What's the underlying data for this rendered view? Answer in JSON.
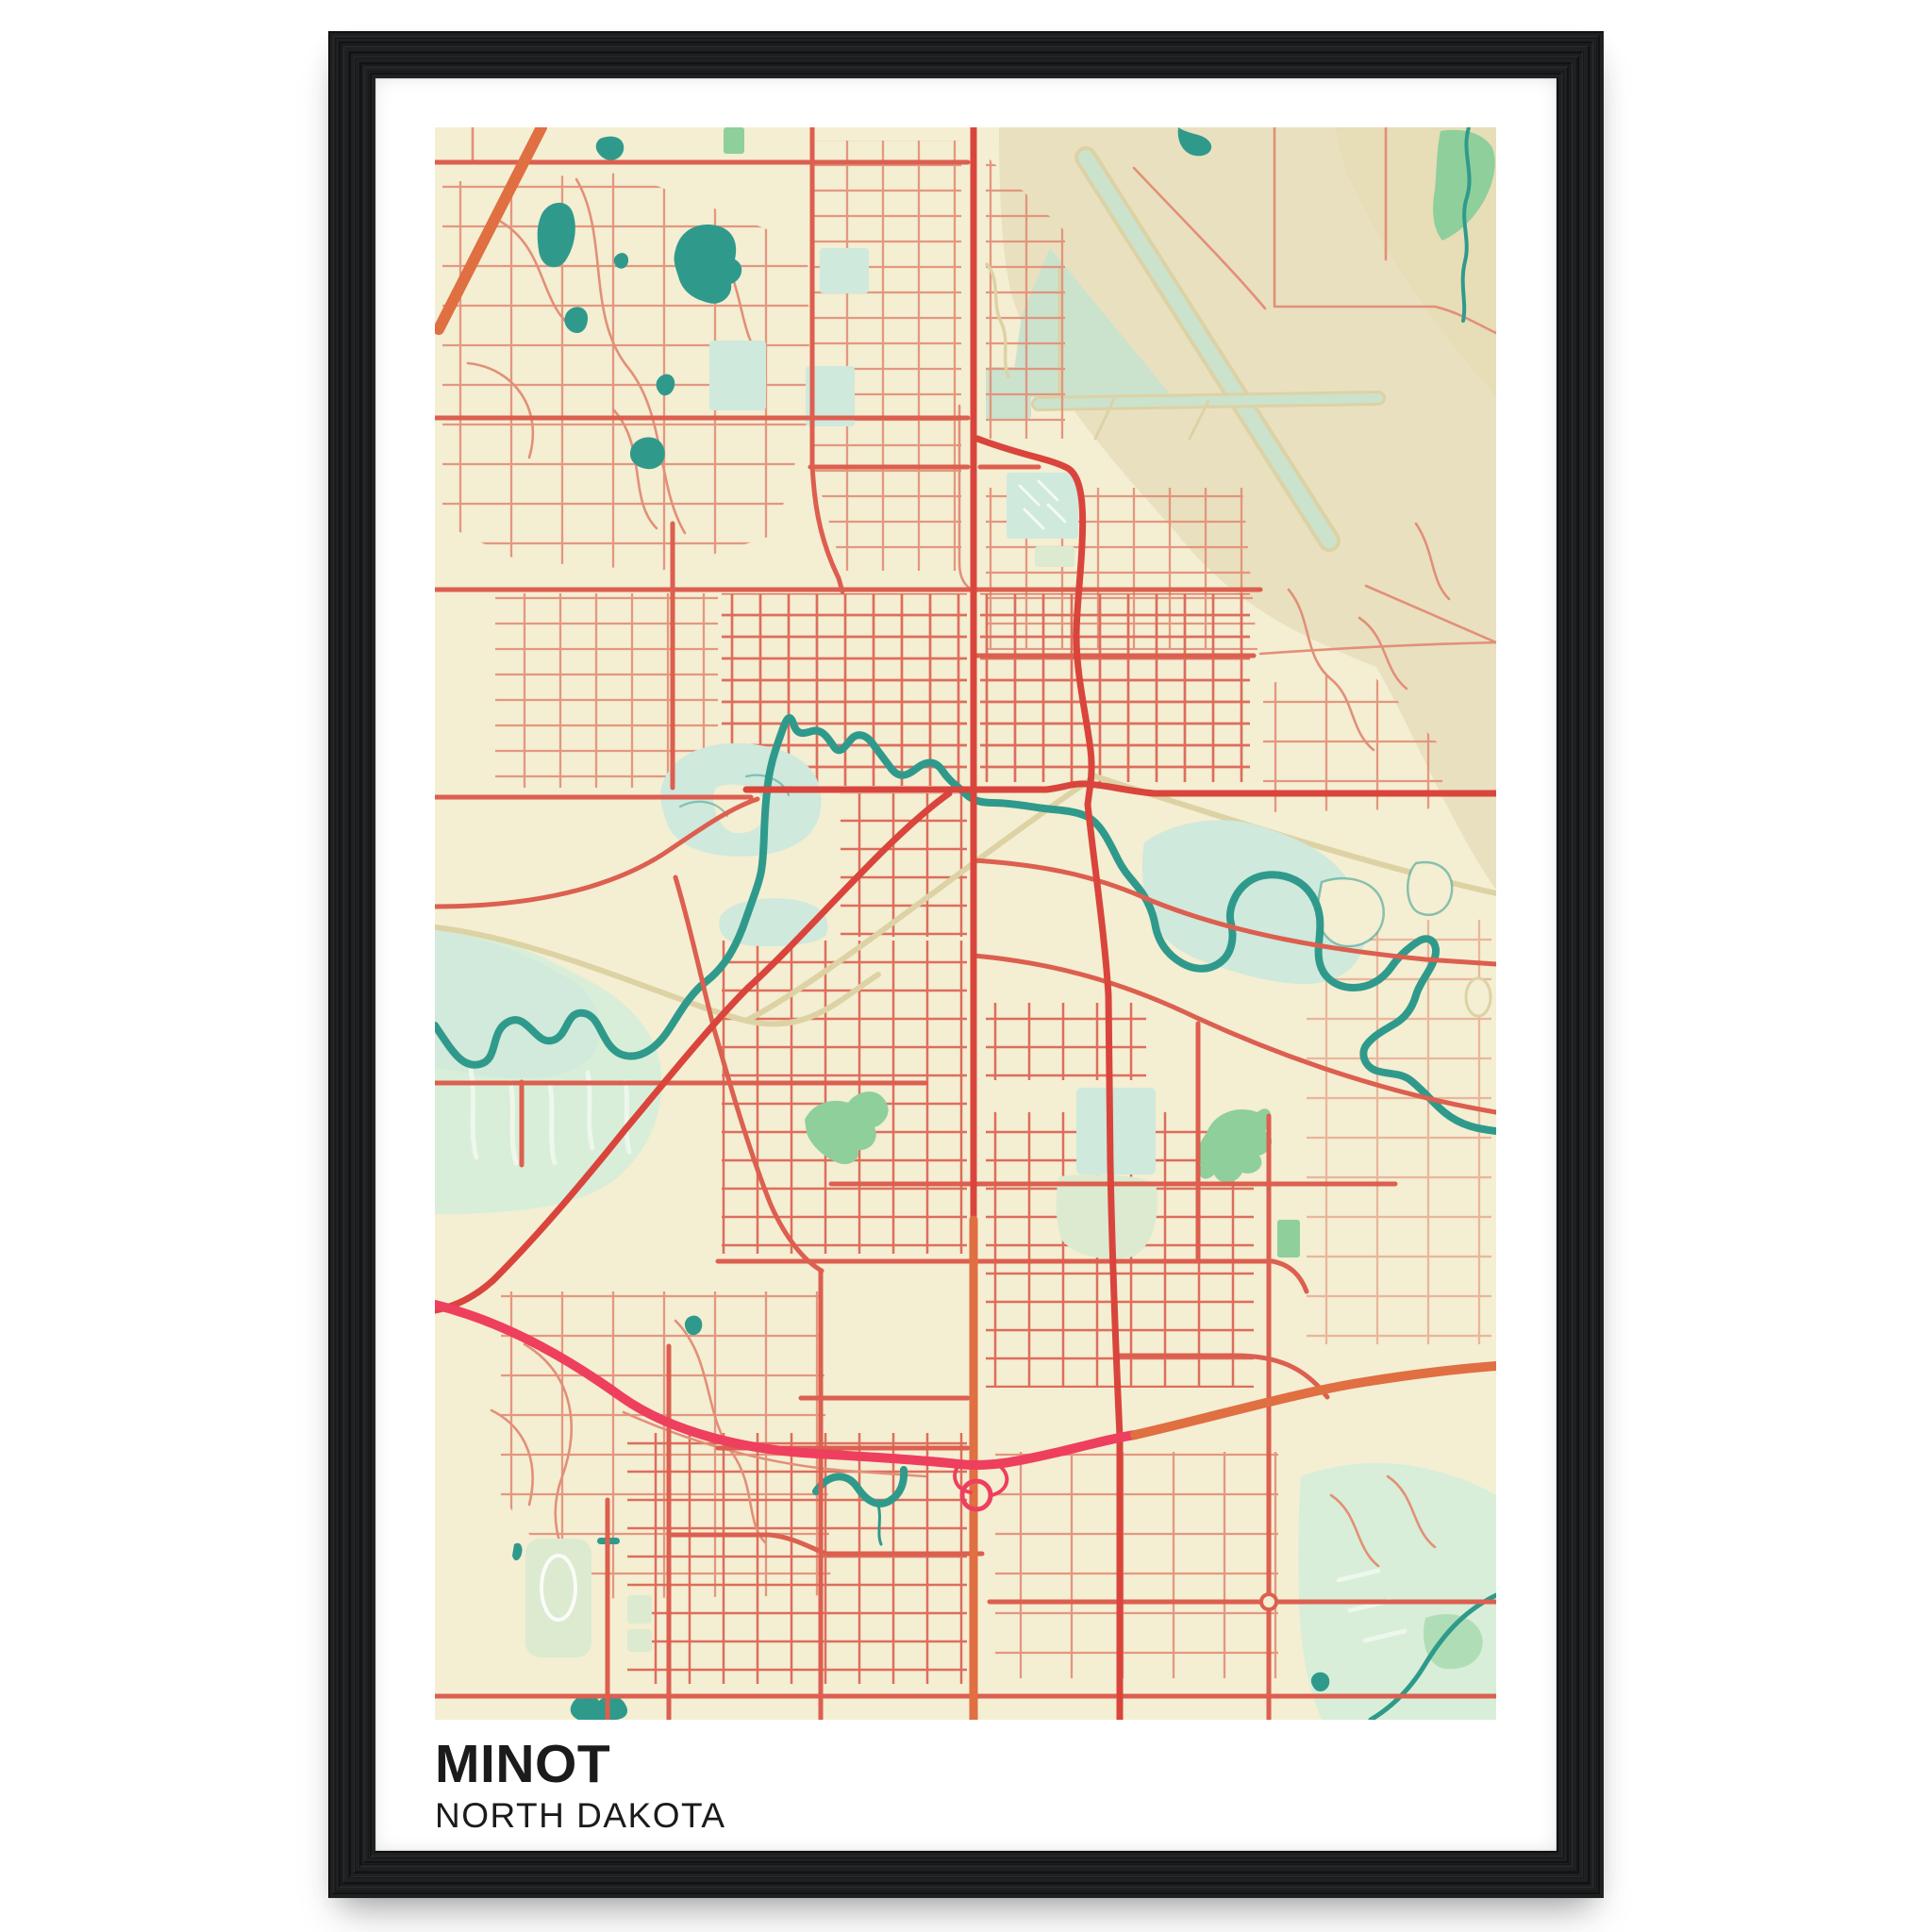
{
  "poster": {
    "title": "MINOT",
    "subtitle": "NORTH DAKOTA"
  },
  "map": {
    "city": "Minot",
    "state": "North Dakota",
    "style": "vintage street map",
    "features": [
      "street grid",
      "Souris river",
      "lakes",
      "airport runways",
      "rail line",
      "highway bypass",
      "parks",
      "wetlands"
    ]
  },
  "colors": {
    "frame": "#1f2021",
    "mat": "#ffffff",
    "map-bg": "#f4eed3",
    "land-tan": "#e9e0bf",
    "land-tan2": "#e5dbb4",
    "runway": "#cbe2cd",
    "rail": "#ddd2a4",
    "marsh": "#d8eed8",
    "water-pale": "#cfe9dc",
    "sage": "#dcead0",
    "park": "#8ecf9b",
    "marsh-stripe": "#edf7ec",
    "water": "#2f9a8c",
    "road-minor": "#e29078",
    "road-grid": "#dc6352",
    "road-med": "#dc5f4f",
    "road-major": "#d9453c",
    "road-orange": "#e06f41",
    "road-crimson": "#ee3f5f",
    "title-text": "#1b1b1b"
  }
}
